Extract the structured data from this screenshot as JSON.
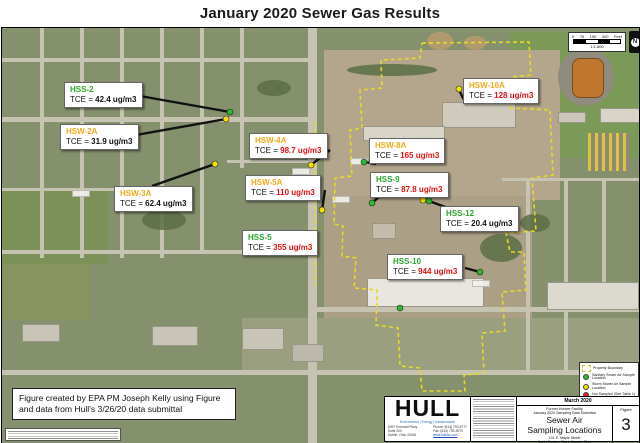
{
  "title": "January 2020 Sewer Gas Results",
  "map": {
    "scale_bar": {
      "ticks": [
        "0",
        "75",
        "150",
        "300"
      ],
      "unit": "Feet",
      "ratio": "1:1,800"
    }
  },
  "legend": {
    "items": [
      {
        "label": "Property Boundary",
        "type": "dashed-line",
        "color": "#e8d825"
      },
      {
        "label": "Sanitary Sewer Air Sample Location",
        "type": "dot",
        "color": "#2db82d"
      },
      {
        "label": "Storm Sewer Air Sample Location",
        "type": "dot",
        "color": "#f2e000"
      },
      {
        "label": "Not Sampled (See Table 1)",
        "type": "dot",
        "color": "#e02020"
      }
    ]
  },
  "sites": [
    {
      "id": "HSS-2",
      "prefix": "TCE =",
      "value": "42.4 ug/m3",
      "id_color": "#2ca42c",
      "value_color": "#111111",
      "marker": "sanitary"
    },
    {
      "id": "HSW-2A",
      "prefix": "TCE =",
      "value": "31.9 ug/m3",
      "id_color": "#f2a71b",
      "value_color": "#111111",
      "marker": "storm"
    },
    {
      "id": "HSW-3A",
      "prefix": "TCE =",
      "value": "62.4 ug/m3",
      "id_color": "#f2a71b",
      "value_color": "#111111",
      "marker": "storm"
    },
    {
      "id": "HSW-4A",
      "prefix": "TCE =",
      "value": "98.7 ug/m3",
      "id_color": "#f2a71b",
      "value_color": "#e01010",
      "marker": "storm"
    },
    {
      "id": "HSW-5A",
      "prefix": "TCE =",
      "value": "110 ug/m3",
      "id_color": "#f2a71b",
      "value_color": "#e01010",
      "marker": "storm"
    },
    {
      "id": "HSS-5",
      "prefix": "TCE =",
      "value": "355 ug/m3",
      "id_color": "#2ca42c",
      "value_color": "#e01010",
      "marker": "sanitary"
    },
    {
      "id": "HSW-8A",
      "prefix": "TCE =",
      "value": "165 ug/m3",
      "id_color": "#f2a71b",
      "value_color": "#e01010",
      "marker": "sanitary"
    },
    {
      "id": "HSS-9",
      "prefix": "TCE =",
      "value": "87.8 ug/m3",
      "id_color": "#2ca42c",
      "value_color": "#e01010",
      "marker": "sanitary"
    },
    {
      "id": "HSS-12",
      "prefix": "TCE =",
      "value": "20.4 ug/m3",
      "id_color": "#2ca42c",
      "value_color": "#111111",
      "marker": "sanitary"
    },
    {
      "id": "HSS-10",
      "prefix": "TCE =",
      "value": "944 ug/m3",
      "id_color": "#2ca42c",
      "value_color": "#e01010",
      "marker": "sanitary"
    },
    {
      "id": "HSW-16A",
      "prefix": "TCE =",
      "value": "128 ug/m3",
      "id_color": "#f2a71b",
      "value_color": "#e01010",
      "marker": "storm"
    }
  ],
  "annotations": {
    "epa_note_line1": "Figure created by EPA PM Joseph Kelly using Figure",
    "epa_note_line2": "and data from Hull's 3/26/20 data submittal"
  },
  "footer": {
    "hull": {
      "logo": "HULL",
      "tagline": "Environment | Energy | Infrastructure",
      "address1": "6397 Emerald Pkwy",
      "address2": "Suite 200",
      "address3": "Dublin, Ohio 43016",
      "phone": "Phone: (614) 793-8777",
      "fax": "Fax: (614) 793-9070",
      "web": "www.hullinc.com"
    },
    "titleblock": {
      "date": "March 2020",
      "project_line1": "Former Hoover Facility",
      "project_line2": "January 2020 Sampling Data Submittal",
      "title_line1": "Sewer Air",
      "title_line2": "Sampling Locations",
      "address_line1": "101 E. Maple Street",
      "address_line2": "North Canton, Stark County, Ohio",
      "figure_label": "Figure",
      "figure_number": "3"
    }
  }
}
